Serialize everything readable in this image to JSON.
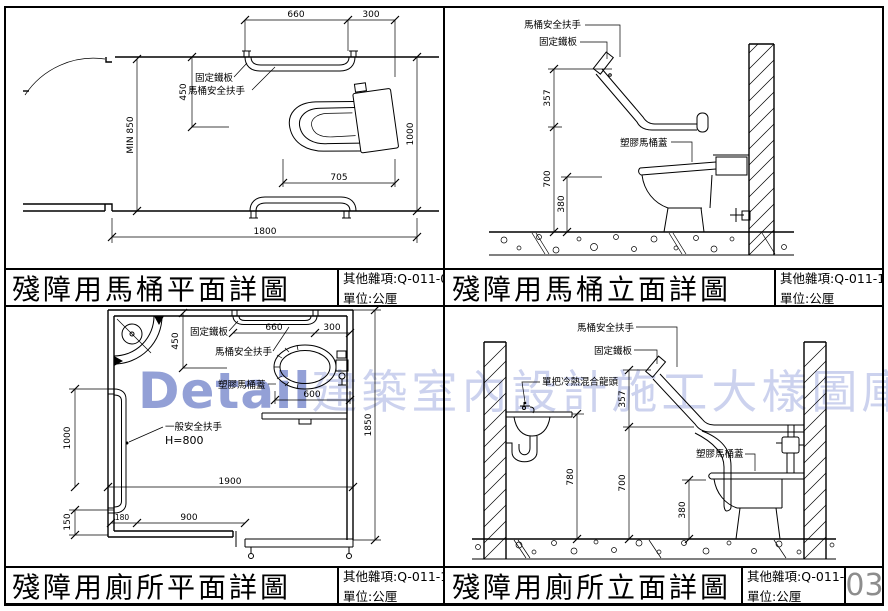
{
  "watermark": {
    "latin": "Detail",
    "cjk": "建築室內設計施工大樣圖庫"
  },
  "page_number": "03",
  "panels": [
    {
      "title": "殘障用馬桶平面詳圖",
      "code": "其他雜項:Q-011-09",
      "unit": "單位:公厘",
      "labels": {
        "fixed_plate": "固定鐵板",
        "grab_bar": "馬桶安全扶手"
      },
      "dims": {
        "bar": "660",
        "side": "300",
        "offset": "450",
        "min_depth": "MIN 850",
        "seat_depth": "705",
        "room_depth": "1000",
        "room_width": "1800"
      }
    },
    {
      "title": "殘障用馬桶立面詳圖",
      "code": "其他雜項:Q-011-10",
      "unit": "單位:公厘",
      "labels": {
        "grab_bar": "馬桶安全扶手",
        "fixed_plate": "固定鐵板",
        "lid": "塑膠馬桶蓋"
      },
      "dims": {
        "upper": "357",
        "lower": "700",
        "seat": "380"
      }
    },
    {
      "title": "殘障用廁所平面詳圖",
      "code": "其他雜項:Q-011-11",
      "unit": "單位:公厘",
      "labels": {
        "fixed_plate": "固定鐵板",
        "grab_bar": "馬桶安全扶手",
        "lid": "塑膠馬桶蓋",
        "side_bar": "一般安全扶手",
        "side_bar_h": "H=800"
      },
      "dims": {
        "offset": "450",
        "bar": "660",
        "side": "300",
        "seat": "600",
        "left": "1000",
        "left_low": "150",
        "jamb": "180",
        "door": "900",
        "width": "1900",
        "depth": "1850"
      }
    },
    {
      "title": "殘障用廁所立面詳圖",
      "code": "其他雜項:Q-011-12",
      "unit": "單位:公厘",
      "labels": {
        "grab_bar": "馬桶安全扶手",
        "fixed_plate": "固定鐵板",
        "faucet": "單把冷熱混合龍頭",
        "lid": "塑膠馬桶蓋"
      },
      "dims": {
        "upper": "357",
        "counter": "780",
        "lower": "700",
        "seat": "380"
      }
    }
  ]
}
